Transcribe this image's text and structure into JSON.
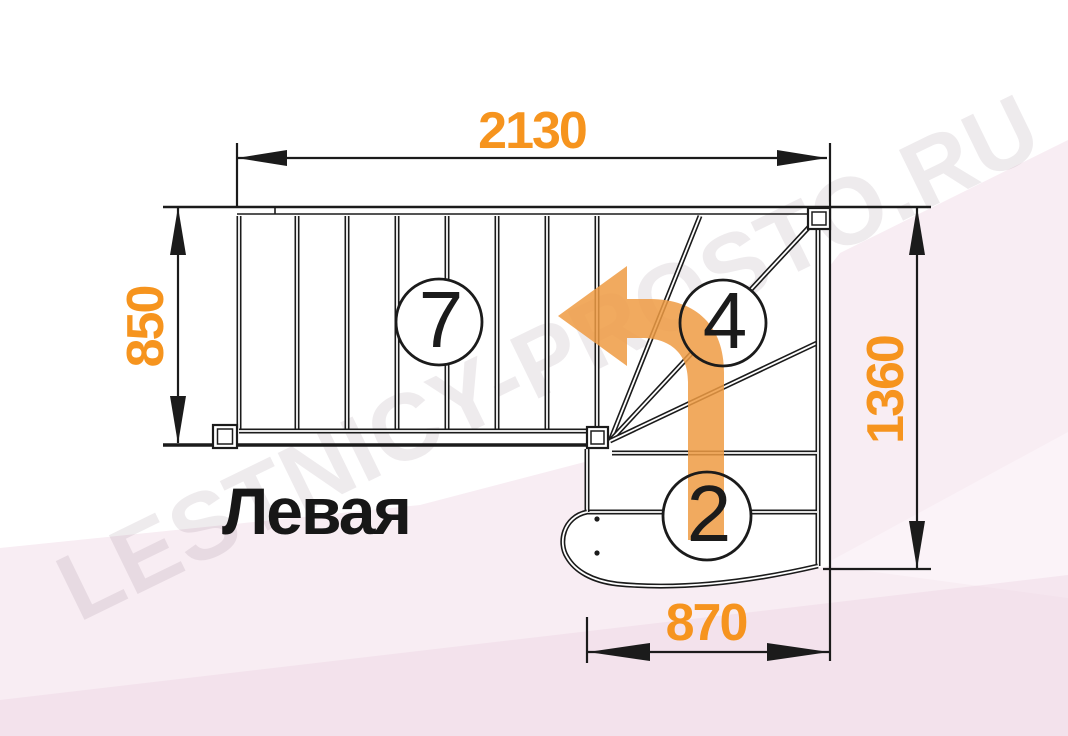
{
  "drawing": {
    "title": "Левая",
    "watermark": "LESTNICY-PROSTO.RU",
    "dimensions": {
      "width_top": "2130",
      "height_left": "850",
      "height_right": "1360",
      "width_bottom": "870"
    },
    "flight_labels": {
      "upper_flight_steps": "7",
      "winder_steps": "4",
      "lower_flight_steps": "2"
    },
    "colors": {
      "dimension_text": "#F6941E",
      "direction_arrow": "#EE9B43",
      "outline": "#1B1B1B",
      "background_tint": "#F8EDF3"
    }
  }
}
